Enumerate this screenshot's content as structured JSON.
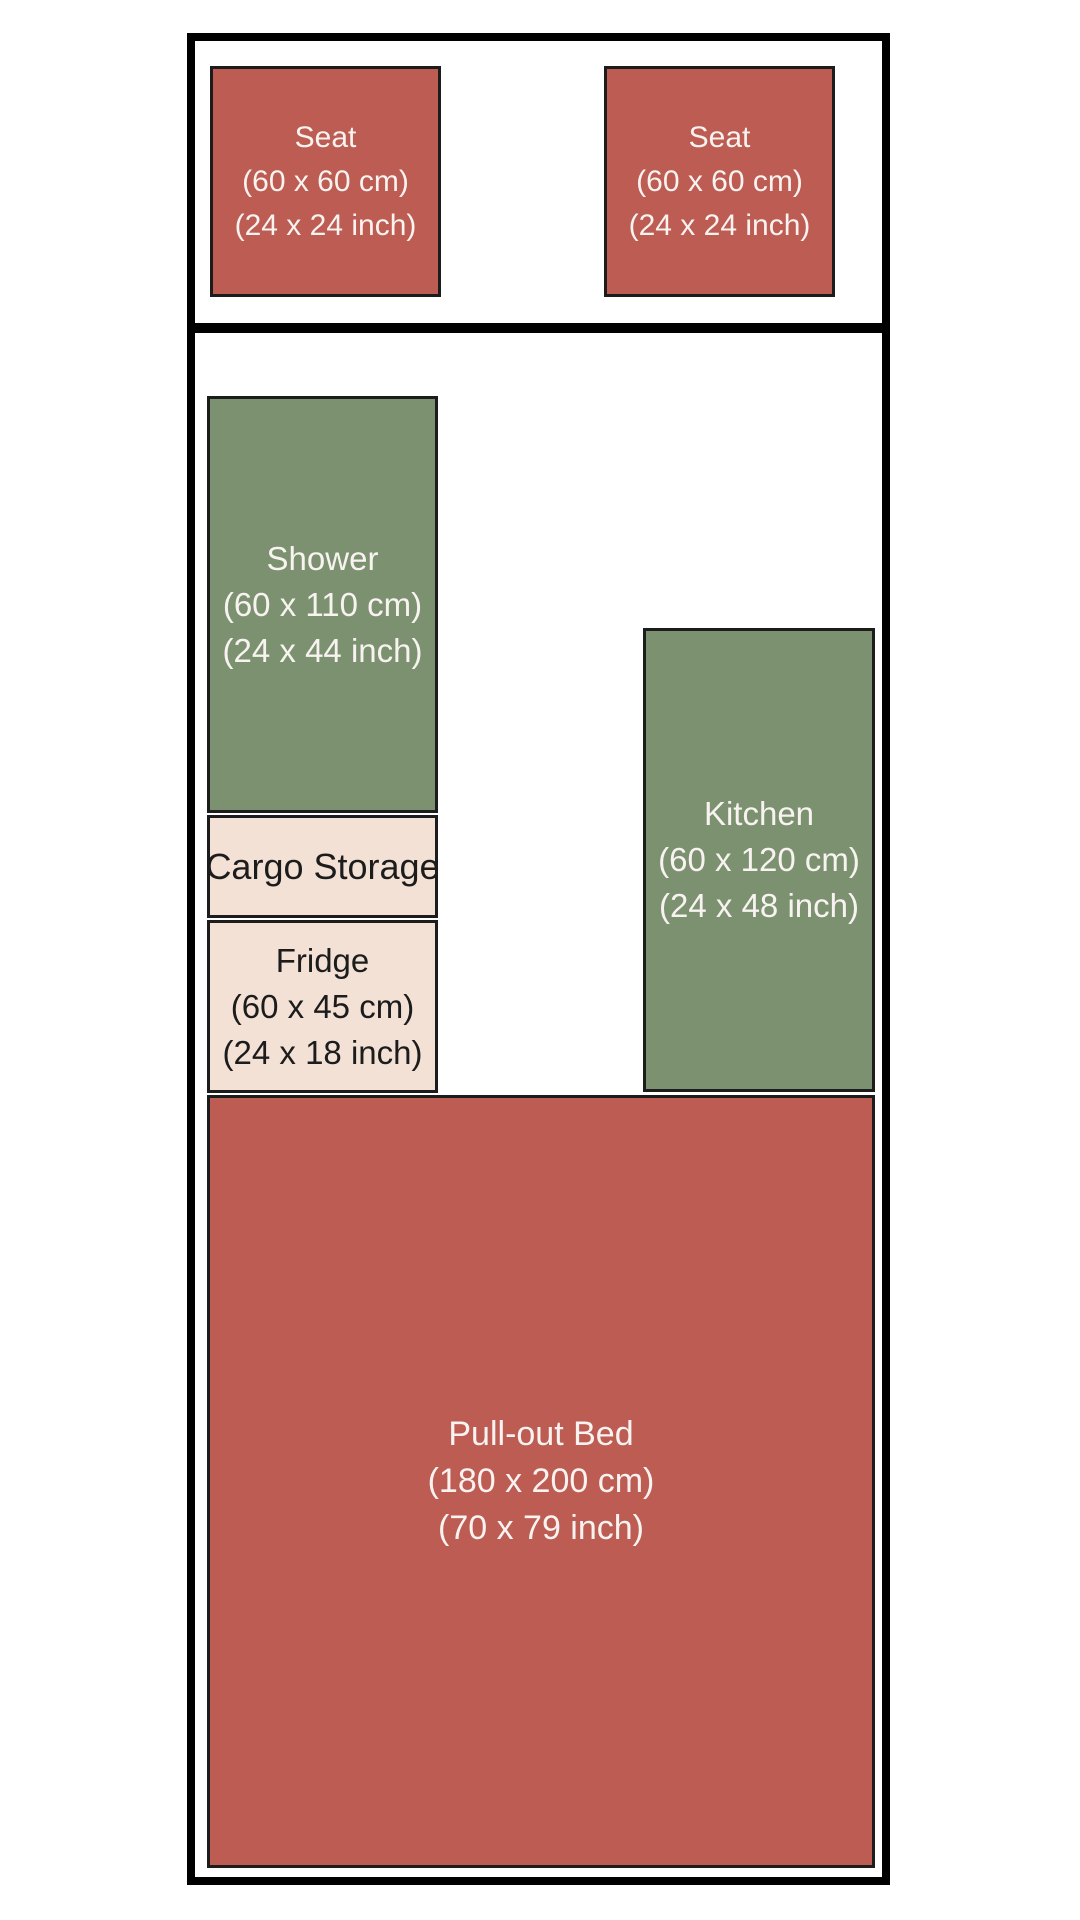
{
  "colors": {
    "seating_red": "#bd5c52",
    "fixture_green": "#7b9170",
    "storage_cream": "#f3e1d5",
    "wall_black": "#000000",
    "light_text": "#f8f3f0",
    "dark_text": "#1c1c1c",
    "background": "#ffffff"
  },
  "floorplan": {
    "rooms": {
      "seat_left": {
        "label": "Seat",
        "dim_cm": "(60 x 60 cm)",
        "dim_inch": "(24 x 24 inch)"
      },
      "seat_right": {
        "label": "Seat",
        "dim_cm": "(60 x 60 cm)",
        "dim_inch": "(24 x 24 inch)"
      },
      "shower": {
        "label": "Shower",
        "dim_cm": "(60 x 110 cm)",
        "dim_inch": "(24 x 44 inch)"
      },
      "cargo_storage": {
        "label": "Cargo Storage"
      },
      "fridge": {
        "label": "Fridge",
        "dim_cm": "(60 x 45 cm)",
        "dim_inch": "(24 x 18 inch)"
      },
      "kitchen": {
        "label": "Kitchen",
        "dim_cm": "(60 x 120 cm)",
        "dim_inch": "(24 x 48 inch)"
      },
      "pullout_bed": {
        "label": "Pull-out Bed",
        "dim_cm": "(180 x 200 cm)",
        "dim_inch": "(70 x 79 inch)"
      }
    }
  }
}
